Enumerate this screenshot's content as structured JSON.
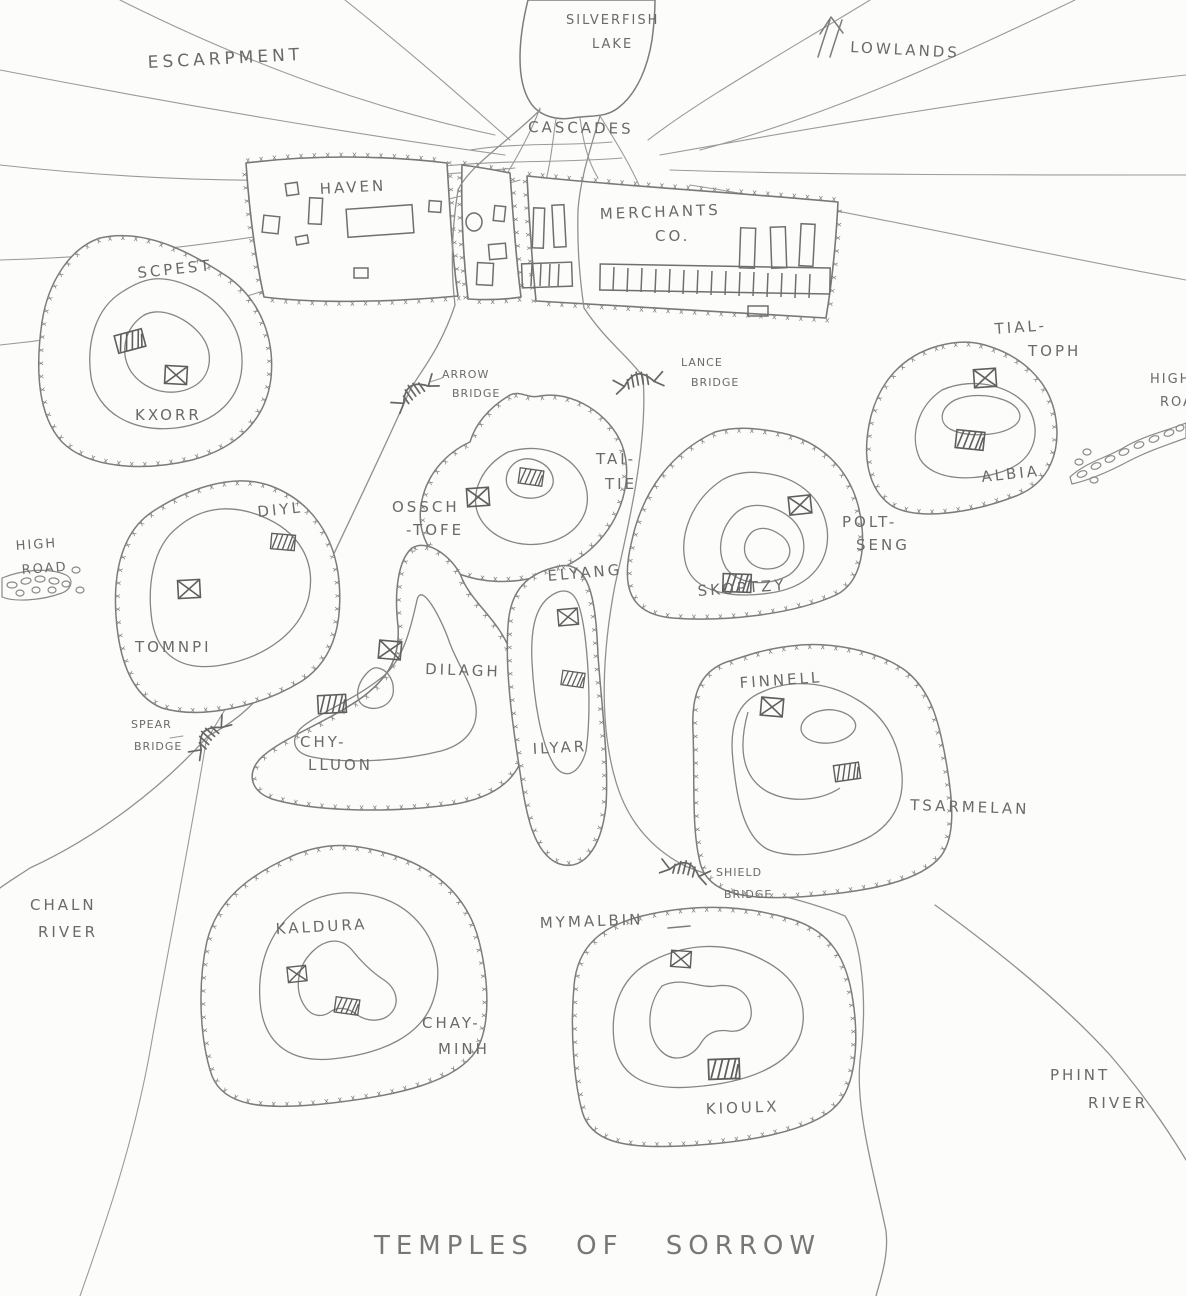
{
  "title": "TEMPLES OF SORROW",
  "colors": {
    "ink": "#6a6a6a",
    "paper": "#fcfcfb"
  },
  "natural_features": {
    "lake_line1": "SILVERFISH",
    "lake_line2": "LAKE",
    "escarpment": "ESCARPMENT",
    "lowlands": "LOWLANDS",
    "cascades": "CASCADES",
    "chaln_river_line1": "CHALN",
    "chaln_river_line2": "RIVER",
    "phint_river_line1": "PHINT",
    "phint_river_line2": "RIVER"
  },
  "roads": {
    "high_road_west_line1": "HIGH",
    "high_road_west_line2": "ROAD",
    "high_road_east_line1": "HIGH",
    "high_road_east_line2": "ROAD"
  },
  "districts": [
    {
      "name": "HAVEN"
    },
    {
      "name_line1": "MERCHANTS",
      "name_line2": "CO."
    }
  ],
  "bridges": [
    {
      "name_line1": "ARROW",
      "name_line2": "BRIDGE"
    },
    {
      "name_line1": "LANCE",
      "name_line2": "BRIDGE"
    },
    {
      "name_line1": "SPEAR",
      "name_line2": "BRIDGE"
    },
    {
      "name_line1": "SHIELD",
      "name_line2": "BRIDGE"
    }
  ],
  "hills": [
    {
      "region": "SCPEST",
      "name": "KXORR",
      "temples": [
        "hatched",
        "cross"
      ]
    },
    {
      "region_line1": "OSSCH",
      "region_line2": "-TOFE",
      "name_line1": "TAI-",
      "name_line2": "TIE",
      "temples": [
        "cross",
        "hatched"
      ]
    },
    {
      "name": "SKOPTZY",
      "region_line1": "POLT-",
      "region_line2": "SENG",
      "temples": [
        "cross",
        "hatched"
      ]
    },
    {
      "region_line1": "TIAL-",
      "region_line2": "TOPH",
      "name": "ALBIA",
      "temples": [
        "cross",
        "hatched"
      ]
    },
    {
      "region": "DIYL",
      "name": "TOMNPI",
      "temples": [
        "hatched",
        "cross"
      ]
    },
    {
      "region": "DILAGH",
      "name_line1": "CHY-",
      "name_line2": "LLUON",
      "temples": [
        "cross",
        "hatched"
      ]
    },
    {
      "region": "ELYANG",
      "name": "ILYAR",
      "temples": [
        "cross",
        "hatched"
      ]
    },
    {
      "name": "FINNELL",
      "region": "TSARMELAN",
      "temples": [
        "cross",
        "hatched"
      ]
    },
    {
      "name": "KALDURA",
      "region_line1": "CHAY-",
      "region_line2": "MINH",
      "temples": [
        "cross",
        "hatched"
      ]
    },
    {
      "region": "MYMALBIN",
      "name": "KIOULX",
      "temples": [
        "cross",
        "hatched"
      ]
    }
  ]
}
